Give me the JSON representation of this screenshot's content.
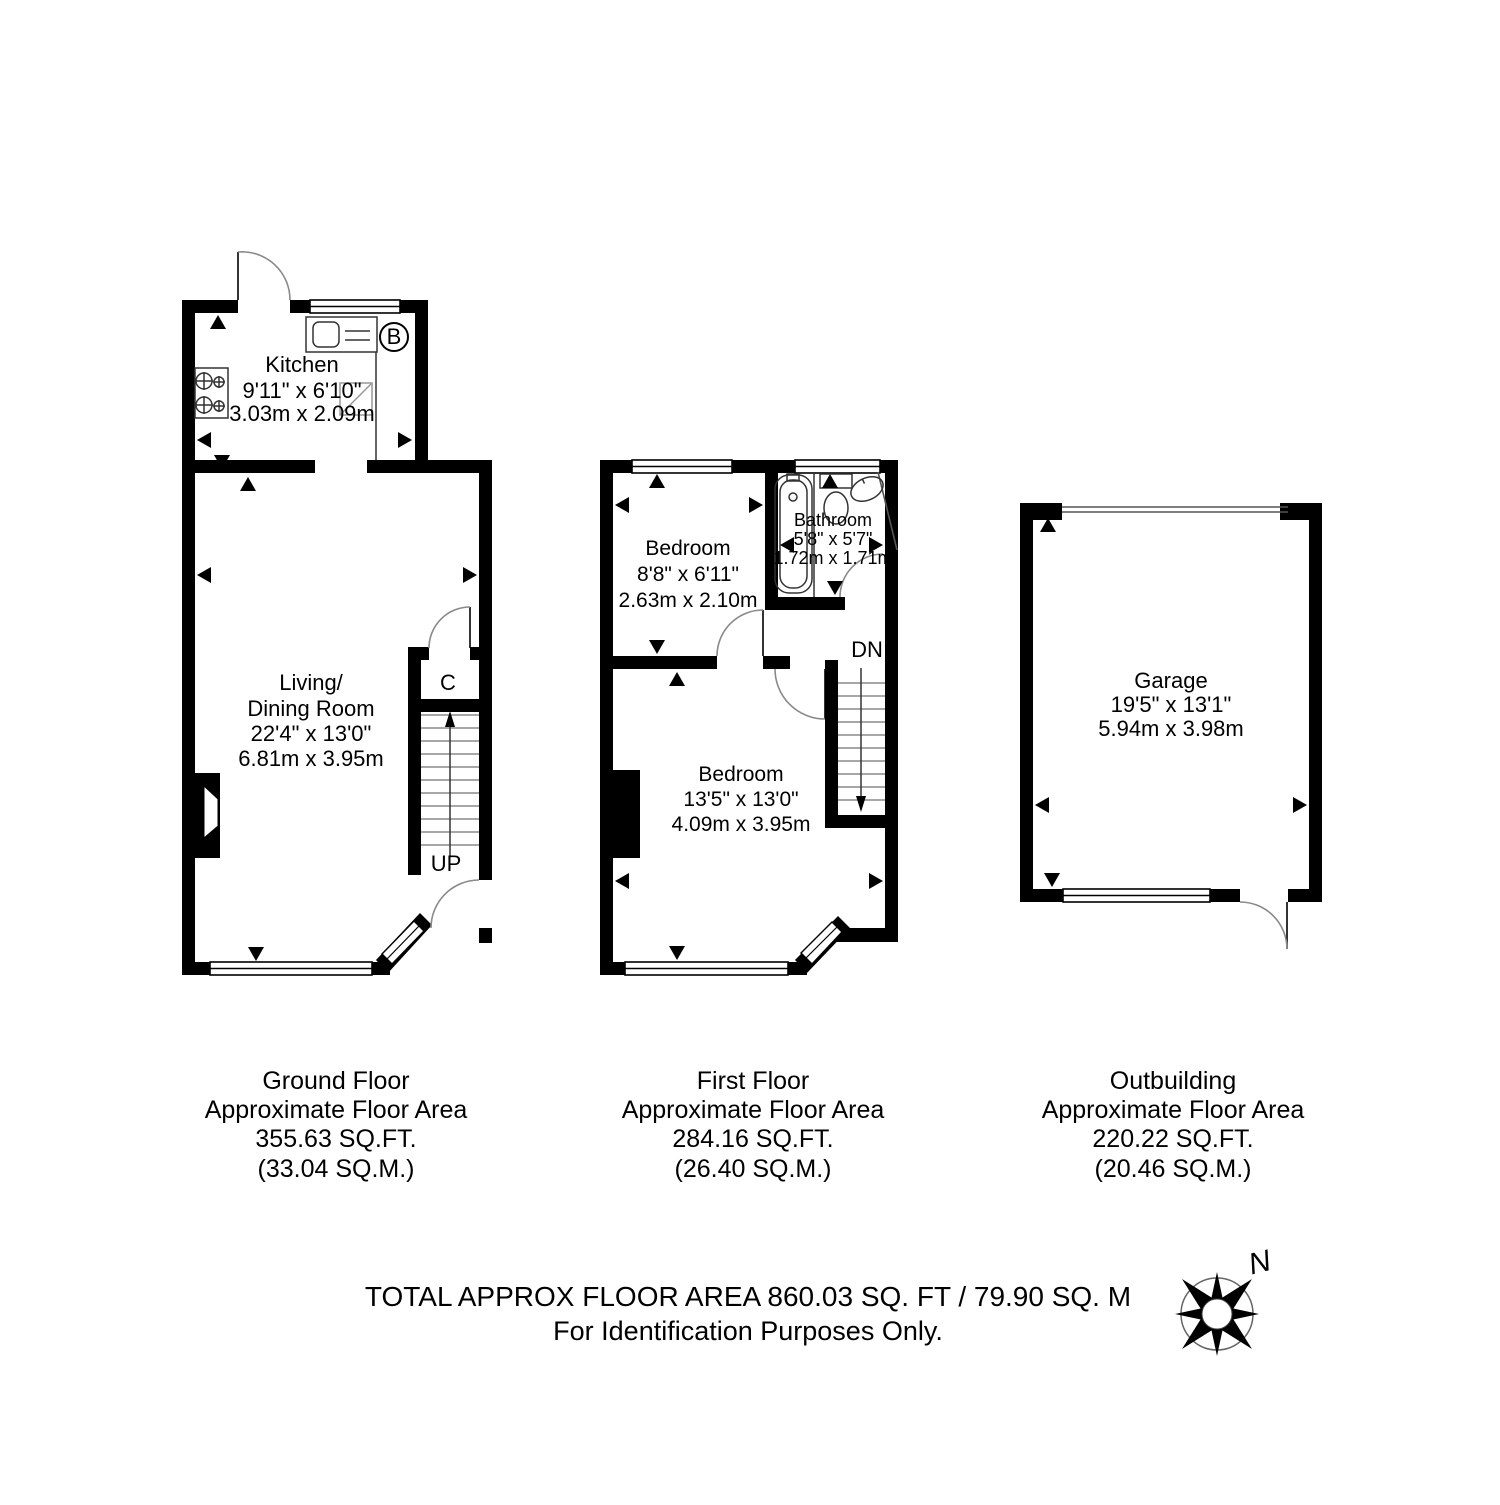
{
  "plan": {
    "rooms": {
      "kitchen": {
        "name": "Kitchen",
        "imperial": "9'11\" x 6'10\"",
        "metric": "3.03m x 2.09m"
      },
      "living": {
        "name_line1": "Living/",
        "name_line2": "Dining Room",
        "imperial": "22'4\" x 13'0\"",
        "metric": "6.81m x 3.95m"
      },
      "bedroom1": {
        "name": "Bedroom",
        "imperial": "8'8\" x 6'11\"",
        "metric": "2.63m x 2.10m"
      },
      "bathroom": {
        "name": "Bathroom",
        "imperial": "5'8\" x 5'7\"",
        "metric": "1.72m x 1.71m"
      },
      "bedroom2": {
        "name": "Bedroom",
        "imperial": "13'5\" x 13'0\"",
        "metric": "4.09m x 3.95m"
      },
      "garage": {
        "name": "Garage",
        "imperial": "19'5\" x 13'1\"",
        "metric": "5.94m x 3.98m"
      }
    },
    "markers": {
      "boiler": "B",
      "cupboard": "C",
      "stairs_up": "UP",
      "stairs_down": "DN",
      "compass_north": "N"
    }
  },
  "floors": [
    {
      "name": "Ground Floor",
      "area_label": "Approximate Floor Area",
      "sqft": "355.63 SQ.FT.",
      "sqm": "(33.04 SQ.M.)"
    },
    {
      "name": "First Floor",
      "area_label": "Approximate Floor Area",
      "sqft": "284.16 SQ.FT.",
      "sqm": "(26.40 SQ.M.)"
    },
    {
      "name": "Outbuilding",
      "area_label": "Approximate Floor Area",
      "sqft": "220.22 SQ.FT.",
      "sqm": "(20.46 SQ.M.)"
    }
  ],
  "footer": {
    "total": "TOTAL APPROX FLOOR AREA 860.03 SQ. FT / 79.90 SQ. M",
    "disclaimer": "For Identification Purposes Only."
  },
  "colors": {
    "wall": "#000000",
    "fixture": "#333333",
    "arc": "#8a8a8a",
    "background": "#ffffff"
  }
}
